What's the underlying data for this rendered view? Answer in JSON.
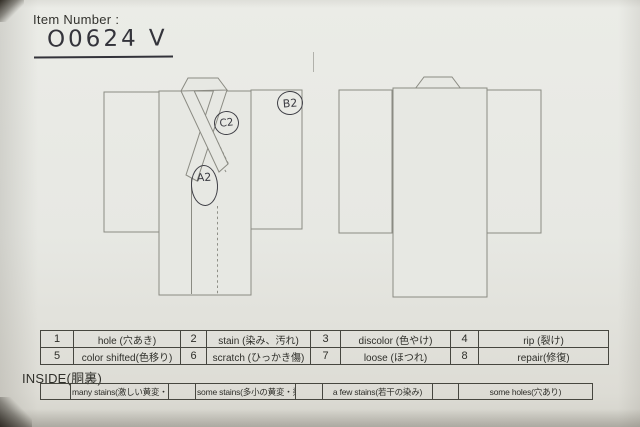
{
  "document": {
    "item_number_label": "Item Number :",
    "item_number_value": "O0624 V"
  },
  "annotations": {
    "front_body": "A2",
    "front_collar": "C2",
    "front_right_sleeve": "B2"
  },
  "defect_codes": {
    "type": "table",
    "rows": [
      [
        "1",
        "hole (穴あき)",
        "2",
        "stain (染み、汚れ)",
        "3",
        "discolor (色やけ)",
        "4",
        "rip (裂け)"
      ],
      [
        "5",
        "color shifted(色移り)",
        "6",
        "scratch (ひっかき傷)",
        "7",
        "loose (ほつれ)",
        "8",
        "repair(修復)"
      ]
    ]
  },
  "inside_section": {
    "label": "INSIDE(胴裏)",
    "cells": [
      "",
      "many stains(激しい黄変・染み)",
      "",
      "some stains(多小の黄変・染み)",
      "",
      "a few stains(若干の染み)",
      "",
      "some holes(穴あり)"
    ]
  },
  "colors": {
    "paper": "#e7e8e3",
    "diagram_line": "#8b8b83",
    "table_border": "#46463f",
    "ink": "#3a3a41",
    "print_text": "#2e2e29"
  }
}
